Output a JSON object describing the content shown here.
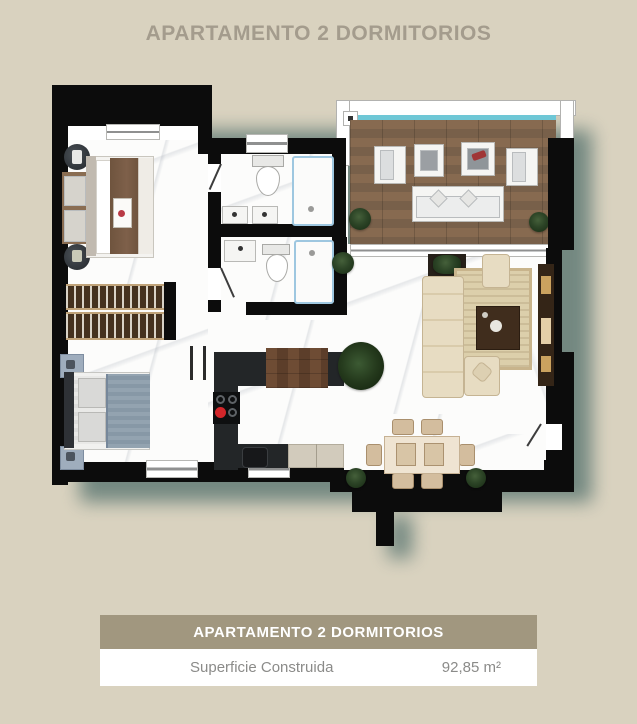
{
  "title": "APARTAMENTO 2 DORMITORIOS",
  "floorplan": {
    "type": "top-down architectural render of a 2-bedroom apartment",
    "rooms": [
      "bedroom-1",
      "bedroom-2",
      "bathroom-1",
      "bathroom-2",
      "wardrobe",
      "kitchen",
      "living-room",
      "dining-area",
      "hallway",
      "terrace"
    ],
    "furniture": [
      "double-bed-1",
      "double-bed-2",
      "nightstands",
      "wardrobe-racks",
      "double-sink-vanity",
      "toilets",
      "showers",
      "kitchen-counter",
      "cooktop",
      "sink",
      "breakfast-bar",
      "dining-table-6-chairs",
      "l-shaped-sofa",
      "coffee-table",
      "armchair",
      "tv-console",
      "outdoor-sofa",
      "lounge-chairs",
      "outdoor-tables",
      "potted-plants"
    ],
    "colors": {
      "wall": "#0c0c0c",
      "floor": "#fcfcfb",
      "terrace_wood": "#84684e",
      "glass_railing": "#6ec7d6",
      "shadow": "#5d7873",
      "accent_red_burner": "#d3262a"
    }
  },
  "summary_card": {
    "header": "APARTAMENTO 2 DORMITORIOS",
    "rows": [
      {
        "label": "Superficie Construida",
        "value": "92,85 m²"
      }
    ]
  },
  "page": {
    "background": "#d9d2bf",
    "title_color": "#a49c8d",
    "card_header_bg": "#a1977f"
  }
}
